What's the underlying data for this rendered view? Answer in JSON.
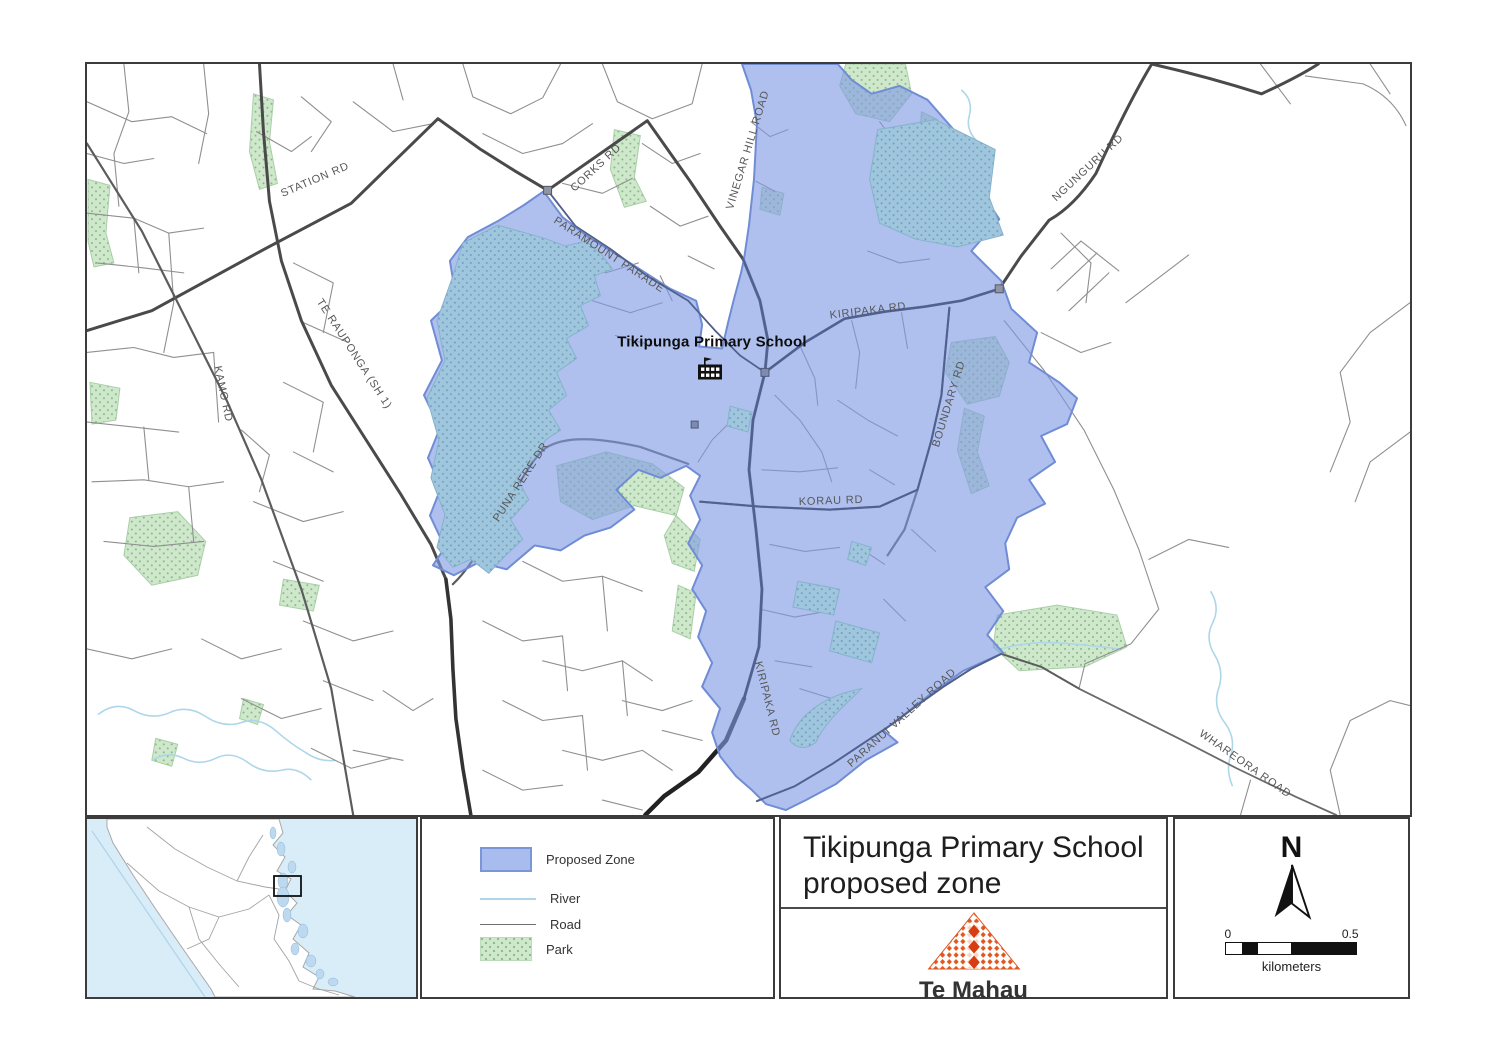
{
  "map": {
    "school": {
      "label": "Tikipunga Primary School"
    },
    "road_labels": [
      {
        "text": "STATION RD",
        "x": 228,
        "y": 116,
        "rot": -23
      },
      {
        "text": "CORKS RD",
        "x": 509,
        "y": 104,
        "rot": -43
      },
      {
        "text": "VINEGAR HILL ROAD",
        "x": 661,
        "y": 86,
        "rot": -73
      },
      {
        "text": "PARAMOUNT PARADE",
        "x": 522,
        "y": 191,
        "rot": 33
      },
      {
        "text": "KIRIPAKA RD",
        "x": 781,
        "y": 247,
        "rot": -7
      },
      {
        "text": "NGUNGURU RD",
        "x": 1001,
        "y": 104,
        "rot": -43
      },
      {
        "text": "TE RAUPONGA (SH 1)",
        "x": 267,
        "y": 290,
        "rot": 57
      },
      {
        "text": "KAMO RD",
        "x": 136,
        "y": 330,
        "rot": 78
      },
      {
        "text": "PUNA RERE DR",
        "x": 434,
        "y": 418,
        "rot": -57
      },
      {
        "text": "BOUNDARY RD",
        "x": 862,
        "y": 340,
        "rot": -73
      },
      {
        "text": "KORAU RD",
        "x": 744,
        "y": 437,
        "rot": -2
      },
      {
        "text": "KIRIPAKA RD",
        "x": 680,
        "y": 635,
        "rot": 76
      },
      {
        "text": "PARANUI VALLEY ROAD",
        "x": 815,
        "y": 654,
        "rot": -42
      },
      {
        "text": "WHAREORA ROAD",
        "x": 1158,
        "y": 700,
        "rot": 35
      }
    ]
  },
  "legend": {
    "items": [
      {
        "label": "Proposed Zone",
        "type": "zone"
      },
      {
        "label": "River",
        "type": "river"
      },
      {
        "label": "Road",
        "type": "road"
      },
      {
        "label": "Park",
        "type": "park"
      }
    ]
  },
  "title_block": {
    "title_line1": "Tikipunga Primary School",
    "title_line2": "proposed zone",
    "logo_text": "Te Mahau"
  },
  "north_scale": {
    "north_label": "N",
    "scale_start": "0",
    "scale_end": "0.5",
    "scale_unit": "kilometers"
  },
  "colors": {
    "proposed_zone": "#a8bcee",
    "zone_border": "#7b96d8",
    "park_green": "#cfe8cc",
    "park_in_zone": "#9fc6dd",
    "river": "#aed6ea",
    "road_major": "#4a4a4a",
    "road_minor": "#8f8f8f",
    "inset_sea": "#d9edf8",
    "logo_orange": "#e0561e"
  }
}
